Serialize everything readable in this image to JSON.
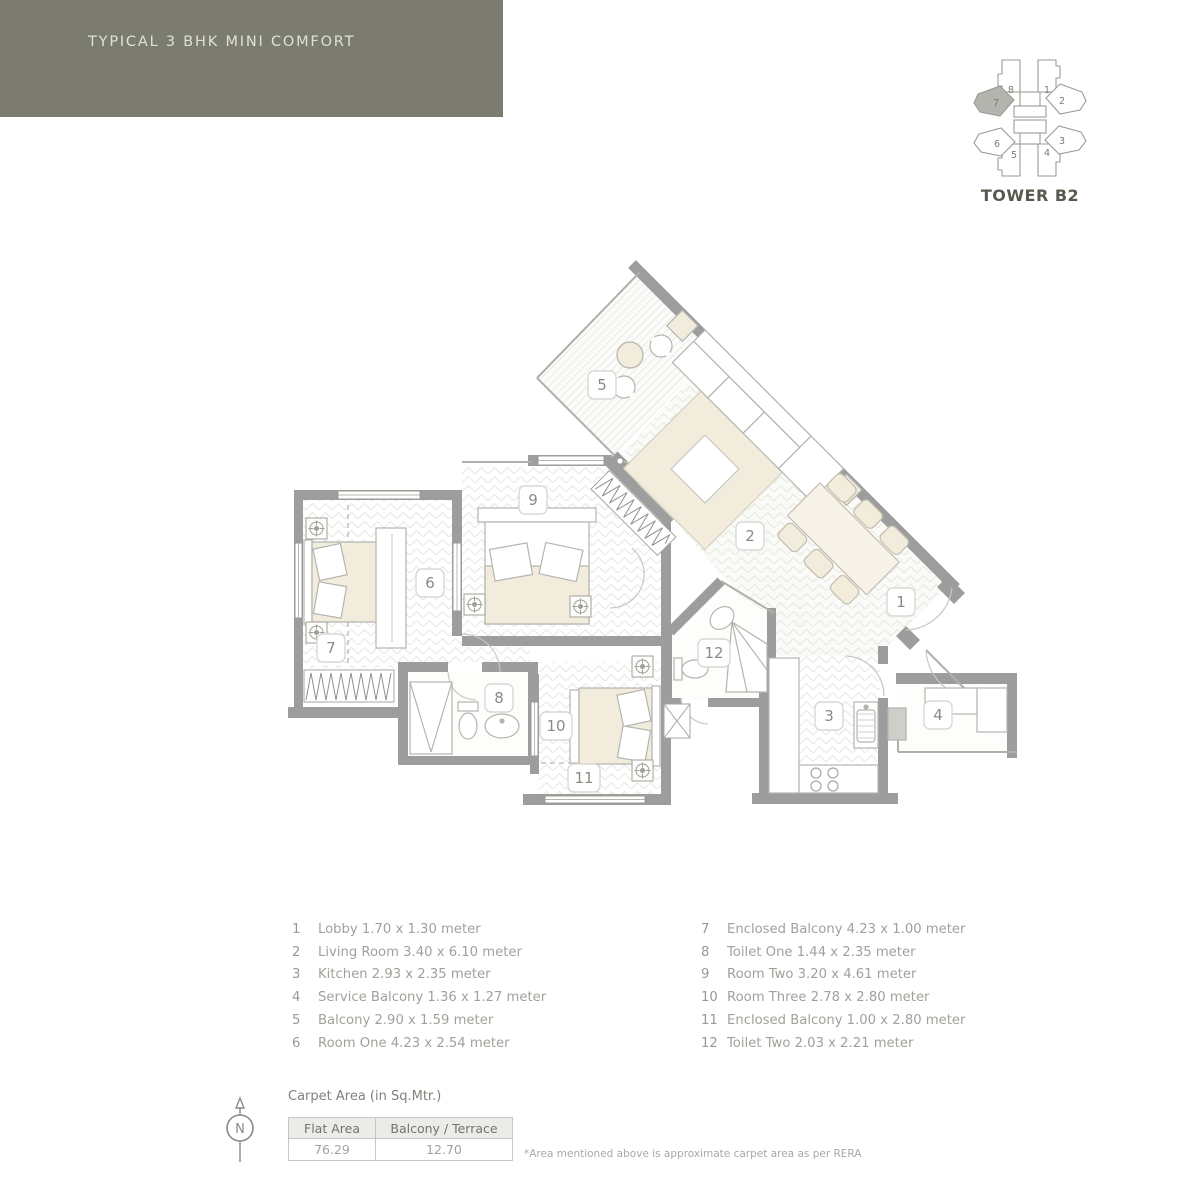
{
  "header": {
    "title": "TYPICAL 3 BHK MINI COMFORT"
  },
  "tower": {
    "label": "TOWER B2",
    "highlighted_unit": "7",
    "unit_numbers": {
      "top_left": "8",
      "top_right": "1",
      "left_upper": "7",
      "right_upper": "2",
      "left_lower": "6",
      "right_lower": "3",
      "bottom_left": "5",
      "bottom_right": "4"
    }
  },
  "plan": {
    "room_numbers": [
      "1",
      "2",
      "3",
      "4",
      "5",
      "6",
      "7",
      "8",
      "9",
      "10",
      "11",
      "12"
    ]
  },
  "legend": {
    "col1": [
      {
        "no": "1",
        "text": "Lobby 1.70 x 1.30 meter"
      },
      {
        "no": "2",
        "text": "Living Room 3.40 x 6.10 meter"
      },
      {
        "no": "3",
        "text": "Kitchen 2.93 x 2.35 meter"
      },
      {
        "no": "4",
        "text": "Service Balcony 1.36 x 1.27 meter"
      },
      {
        "no": "5",
        "text": "Balcony 2.90 x 1.59 meter"
      },
      {
        "no": "6",
        "text": "Room One 4.23 x 2.54 meter"
      }
    ],
    "col2": [
      {
        "no": "7",
        "text": "Enclosed Balcony 4.23 x 1.00 meter"
      },
      {
        "no": "8",
        "text": "Toilet One 1.44 x 2.35 meter"
      },
      {
        "no": "9",
        "text": "Room Two 3.20 x 4.61 meter"
      },
      {
        "no": "10",
        "text": "Room Three 2.78 x 2.80 meter"
      },
      {
        "no": "11",
        "text": "Enclosed Balcony 1.00 x 2.80 meter"
      },
      {
        "no": "12",
        "text": "Toilet Two 2.03 x 2.21 meter"
      }
    ]
  },
  "carpet_area": {
    "title": "Carpet Area (in Sq.Mtr.)",
    "columns": [
      "Flat Area",
      "Balcony / Terrace"
    ],
    "values": [
      "76.29",
      "12.70"
    ],
    "footnote": "*Area mentioned above is approximate carpet area as per RERA"
  },
  "compass": {
    "label": "N"
  },
  "colors": {
    "header_band": "#7b7b70",
    "header_text": "#e0e0da",
    "wall": "#9d9d9d",
    "floor_pattern": "#e8e8e3",
    "furniture_beige": "#f2ecdd",
    "label_text": "#8b8b84",
    "tower_highlight": "#b4b4ae"
  }
}
